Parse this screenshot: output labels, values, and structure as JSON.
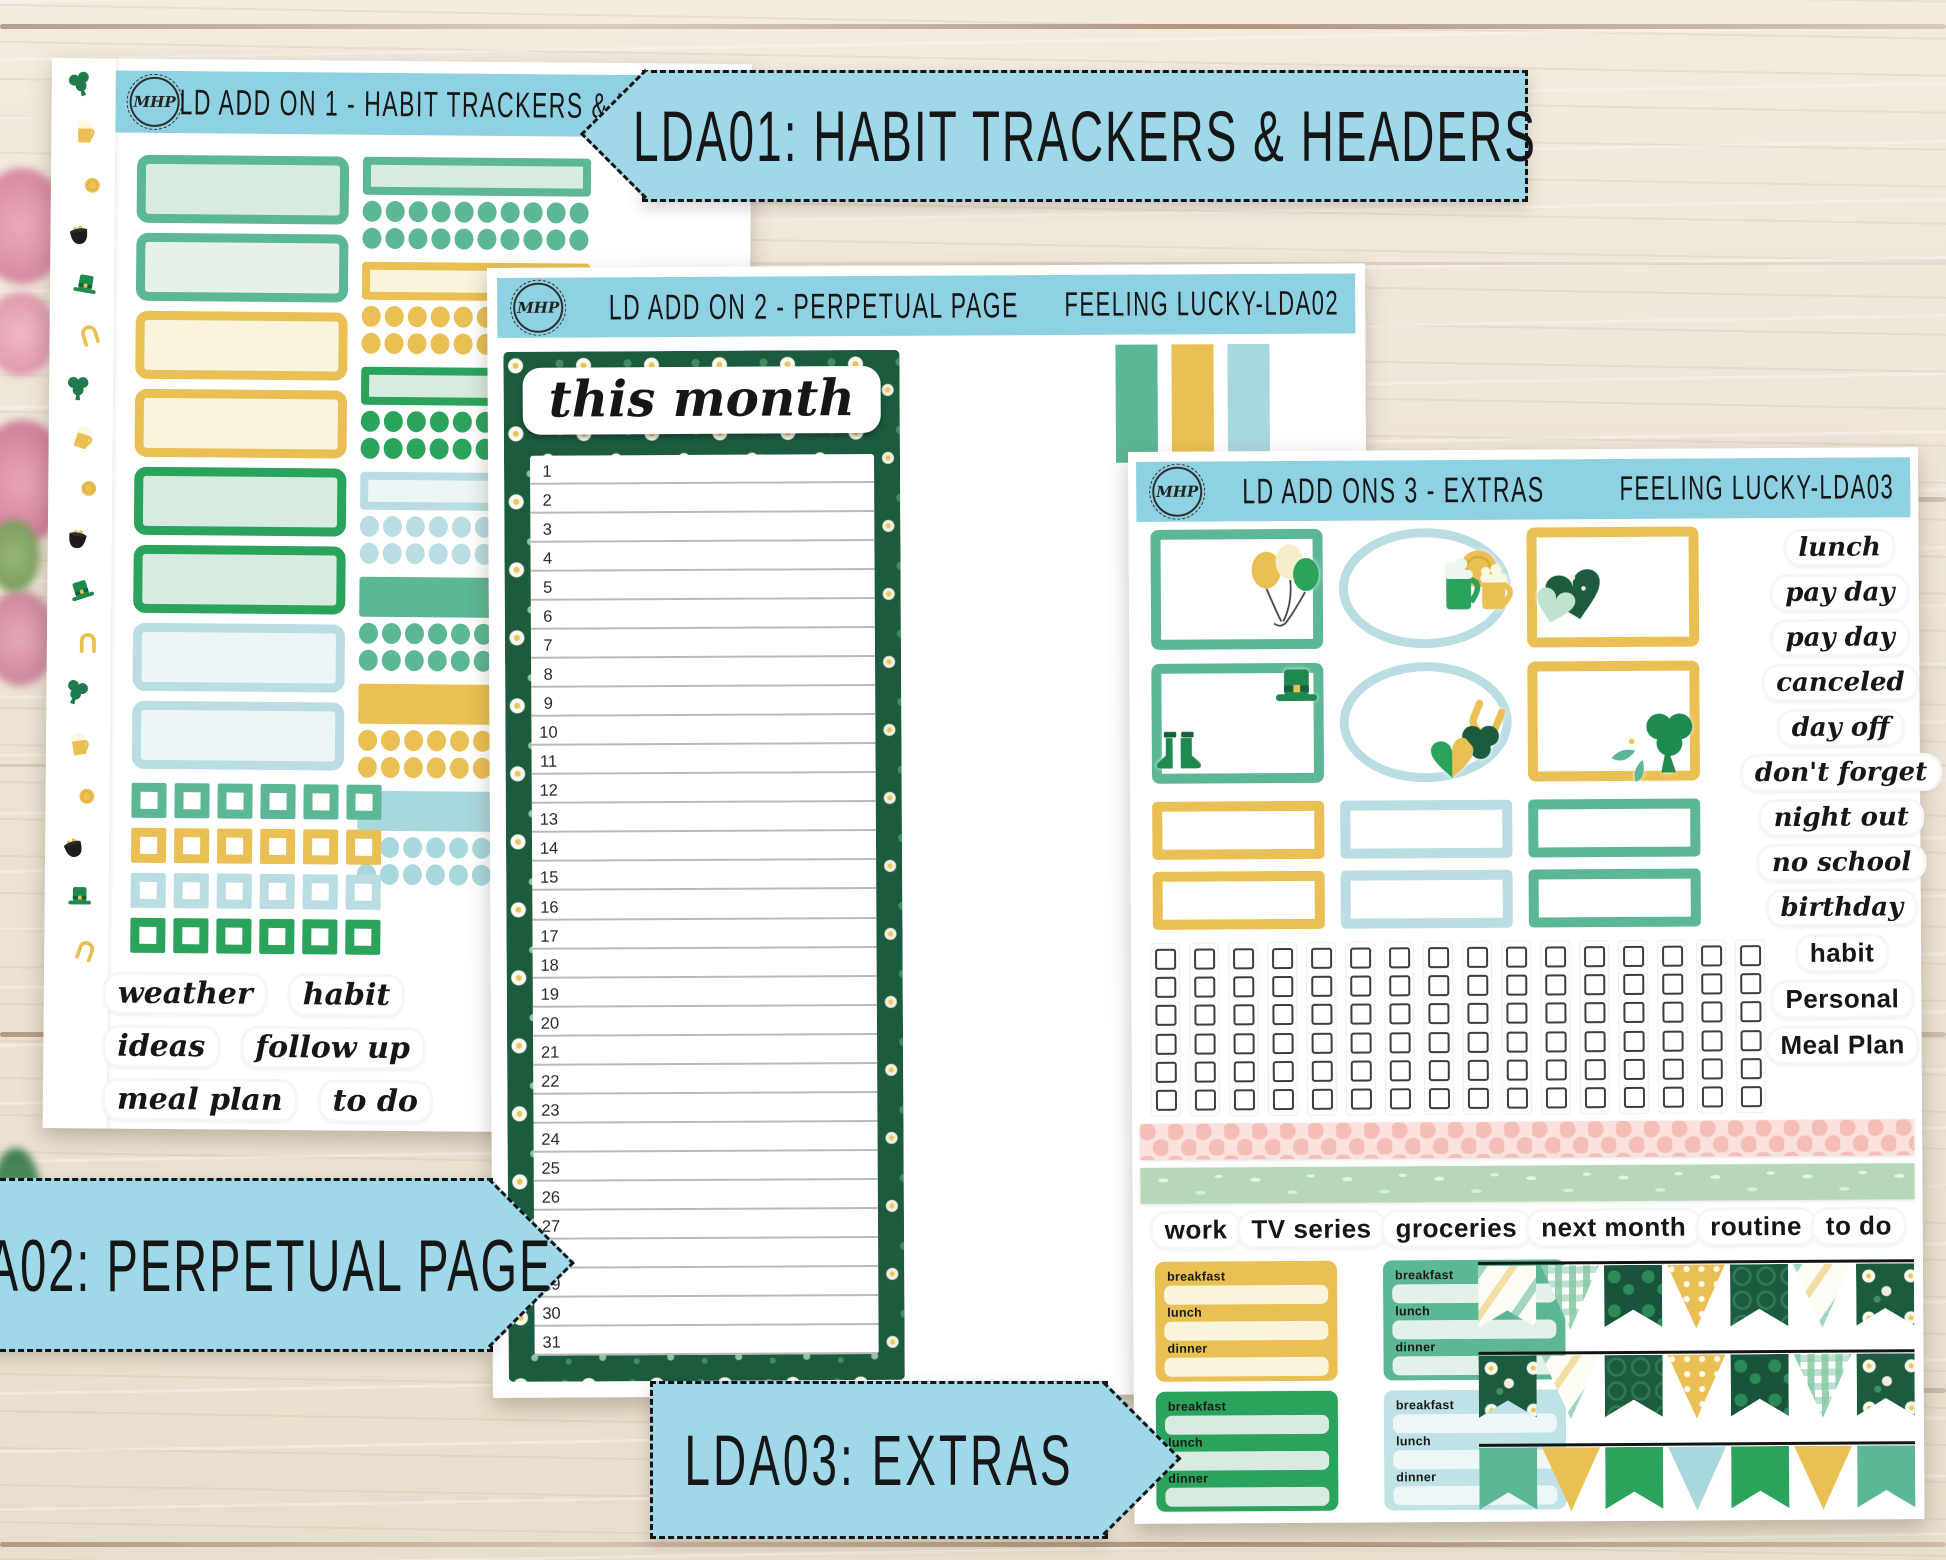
{
  "palette": {
    "banner_blue": "#9fd8e8",
    "sheet_header_blue": "#8ed1e2",
    "seafoam": "#5cb794",
    "mint": "#d8ebe0",
    "pale_mint": "#e6f1ea",
    "kelly_green": "#2aa45d",
    "gold": "#eac054",
    "cream": "#faf4dd",
    "light_blue": "#b9dde2",
    "pale_blue": "#edf6f6",
    "dark_green": "#1c5b3e",
    "pink_washi": "#fbe2de",
    "sage_washi": "#b6d7b8",
    "ink": "#141414",
    "wood": "#ece3d4"
  },
  "brand": {
    "logo": "MHP"
  },
  "banners": {
    "lda01": "LDA01: HABIT TRACKERS & HEADERS",
    "lda02": "LDA02: PERPETUAL PAGE",
    "lda03": "LDA03: EXTRAS"
  },
  "sheet1": {
    "title": "LD ADD ON 1 - HABIT TRACKERS & HEADERS",
    "code": "FEELING LUCKY-LDA01",
    "washi_icons": [
      "clover-icon",
      "beer-mug-icon",
      "gold-coin-icon",
      "pot-of-gold-icon",
      "leprechaun-hat-icon",
      "horseshoe-icon"
    ],
    "washi_icon_count": 18,
    "left_boxes": [
      {
        "border": "#5cb794",
        "fill": "#d8ebe0"
      },
      {
        "border": "#5cb794",
        "fill": "#e6f1ea"
      },
      {
        "border": "#eac054",
        "fill": "#faf4dd"
      },
      {
        "border": "#eac054",
        "fill": "#faf4dd"
      },
      {
        "border": "#2aa45d",
        "fill": "#d8ebe0"
      },
      {
        "border": "#2aa45d",
        "fill": "#d8ebe0"
      },
      {
        "border": "#b9dde2",
        "fill": "#edf6f6"
      },
      {
        "border": "#b9dde2",
        "fill": "#edf6f6"
      }
    ],
    "right_groups": [
      {
        "style": "outline",
        "color": "#5cb794",
        "fill": "#d8ebe0"
      },
      {
        "style": "outline",
        "color": "#eac054",
        "fill": "#faf4dd"
      },
      {
        "style": "outline",
        "color": "#2aa45d",
        "fill": "#d8ebe0"
      },
      {
        "style": "outline",
        "color": "#b9dde2",
        "fill": "#edf6f6"
      },
      {
        "style": "solid",
        "color": "#5cb794"
      },
      {
        "style": "solid",
        "color": "#eac054"
      },
      {
        "style": "solid",
        "color": "#a8d8de"
      }
    ],
    "dots_per_row": 10,
    "checkbox_rows": [
      "#5cb794",
      "#eac054",
      "#b9dde2",
      "#2aa45d"
    ],
    "checkboxes_per_row": 6,
    "script_words": [
      "weather",
      "habit",
      "ideas",
      "follow up",
      "meal plan",
      "to do"
    ]
  },
  "sheet2": {
    "title": "LD ADD ON 2 - PERPETUAL PAGE",
    "code": "FEELING LUCKY-LDA02",
    "page_title": "this month",
    "days": [
      1,
      2,
      3,
      4,
      5,
      6,
      7,
      8,
      9,
      10,
      11,
      12,
      13,
      14,
      15,
      16,
      17,
      18,
      19,
      20,
      21,
      22,
      23,
      24,
      25,
      26,
      27,
      28,
      29,
      30,
      31
    ],
    "color_bars": [
      "#5cb794",
      "#eac054",
      "#a8d8de"
    ]
  },
  "sheet3": {
    "title": "LD ADD ONS 3 - EXTRAS",
    "code": "FEELING LUCKY-LDA03",
    "frames": [
      {
        "shape": "rect",
        "color": "#5cb794",
        "decorations": [
          {
            "icon": "balloons-icon",
            "pos": "r"
          }
        ]
      },
      {
        "shape": "oval",
        "color": "#b9dde2",
        "decorations": [
          {
            "icon": "beer-mugs-icon",
            "pos": "r"
          }
        ]
      },
      {
        "shape": "rect",
        "color": "#eac054",
        "decorations": [
          {
            "icon": "hearts-icon",
            "pos": "l"
          }
        ]
      },
      {
        "shape": "rect",
        "color": "#5cb794",
        "decorations": [
          {
            "icon": "leprechaun-hat-icon",
            "pos": "tr"
          },
          {
            "icon": "boots-icon",
            "pos": "bl"
          }
        ]
      },
      {
        "shape": "oval",
        "color": "#b9dde2",
        "decorations": [
          {
            "icon": "horseshoe-shamrock-heart-icon",
            "pos": "br"
          }
        ]
      },
      {
        "shape": "rect",
        "color": "#eac054",
        "decorations": [
          {
            "icon": "clover-sprig-icon",
            "pos": "br"
          }
        ]
      }
    ],
    "label_box_colors": [
      "#eac054",
      "#b9dde2",
      "#5cb794"
    ],
    "label_box_rows": 2,
    "checkbox_grid": {
      "cols": 16,
      "rows": 6
    },
    "washi_strips": [
      {
        "name": "pink-honeycomb-washi"
      },
      {
        "name": "sage-leaf-washi"
      }
    ],
    "label_words": [
      "work",
      "TV series",
      "groceries",
      "next month",
      "routine",
      "to do"
    ],
    "script_words": [
      "lunch",
      "pay day",
      "pay day",
      "canceled",
      "day off",
      "don't forget",
      "night out",
      "no school",
      "birthday"
    ],
    "print_words": [
      "habit",
      "Personal",
      "Meal Plan"
    ],
    "meal_labels": [
      "breakfast",
      "lunch",
      "dinner"
    ],
    "meal_boxes": [
      {
        "color": "#eac054",
        "fill": "#faf4dd"
      },
      {
        "color": "#5cb794",
        "fill": "#e2f1ea"
      },
      {
        "color": "#2aa45d",
        "fill": "#d8ebe0"
      },
      {
        "color": "#bfe2e6",
        "fill": "#eef7f7"
      }
    ],
    "pennant_rows": [
      {
        "style": "patterned",
        "patterns": [
          "stripe-light",
          "gingham",
          "clover-dark",
          "gold-dots",
          "lattice-dark",
          "stripe-light",
          "daisy-dark"
        ]
      },
      {
        "style": "patterned",
        "patterns": [
          "daisy-dark",
          "stripe-light",
          "lattice-dark",
          "gold-dots",
          "clover-dark",
          "gingham",
          "daisy-dark"
        ]
      },
      {
        "style": "solid",
        "colors": [
          "#5cb794",
          "#eac054",
          "#2aa45d",
          "#a8d8de",
          "#2aa45d",
          "#eac054",
          "#5cb794"
        ]
      }
    ]
  }
}
